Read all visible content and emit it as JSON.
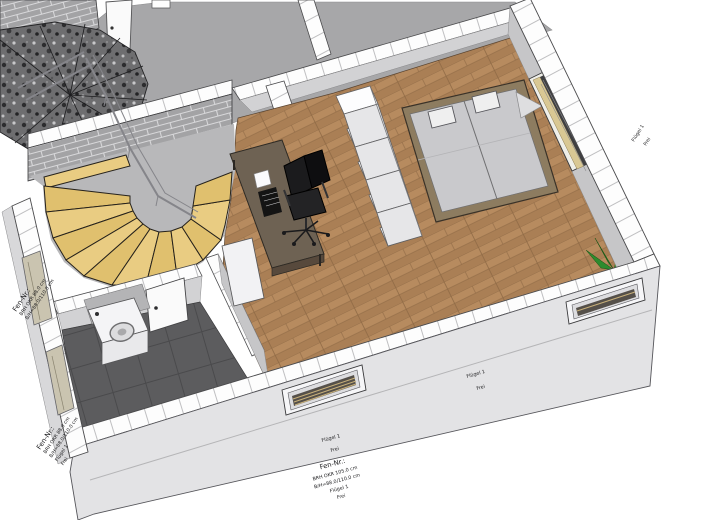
{
  "scene": {
    "type": "3d-floor-plan-cutaway",
    "background": "#ffffff"
  },
  "palette": {
    "bg": "#ffffff",
    "outline": "#2e2e30",
    "cut_wall": "#fdfdfd",
    "cut_joint": "#bfbfc1",
    "wall_face": "#d2d2d4",
    "wall_face_dark": "#c6c6c8",
    "exterior_face": "#e3e3e5",
    "floor_gray": "#a7a7a9",
    "floor_gray_light": "#b8b8ba",
    "brick": "#a3a3a5",
    "brick_joint": "#d8d8da",
    "granite": "#6e6e70",
    "stair_wood": "#e9cc82",
    "stair_wood_alt": "#e0c06e",
    "parquet": "#b78b5f",
    "parquet_alt": "#aa7f55",
    "parquet_joint": "#8f6a45",
    "tile": "#5c5c5e",
    "tile_joint": "#4a4a4c",
    "bed_frame": "#8d7c60",
    "mattress": "#c9c9cc",
    "pillow": "#efefef",
    "desk": "#6e6253",
    "desk_dark": "#57493c",
    "chair": "#1a1a1c",
    "cabinet": "#f4f4f6",
    "door": "#fafafa",
    "window_blind": "#3f3f41",
    "window_wood": "#d9c894",
    "plant": "#2e8b2e",
    "plant_dark": "#1f6f1f",
    "plant_light": "#4bc24b",
    "railing": "#85858a",
    "label": "#1c1c1e"
  },
  "annotations": {
    "window_left_upper": {
      "lines": [
        "Fen-Nr.:",
        "BRH OKR 88.0 cm",
        "B/H=88.0/110.0 cm"
      ]
    },
    "window_left_lower": {
      "lines": [
        "Fen-Nr.:",
        "BRH OKR 88.0 cm",
        "B/H=88.0/110.0 cm",
        "Flügel 1",
        "Frei"
      ]
    },
    "window_front_center": {
      "wing": "Flügel 1",
      "state": "Frei",
      "lines": [
        "Fen-Nr.:",
        "BRH OKR 105.0 cm",
        "B/H=88.0/110.0 cm",
        "Flügel 1",
        "Frei"
      ]
    },
    "window_front_right": {
      "wing": "Flügel 1",
      "state": "Frei"
    },
    "window_right_wall": {
      "wing": "Flügel 1",
      "state": "Frei"
    }
  }
}
